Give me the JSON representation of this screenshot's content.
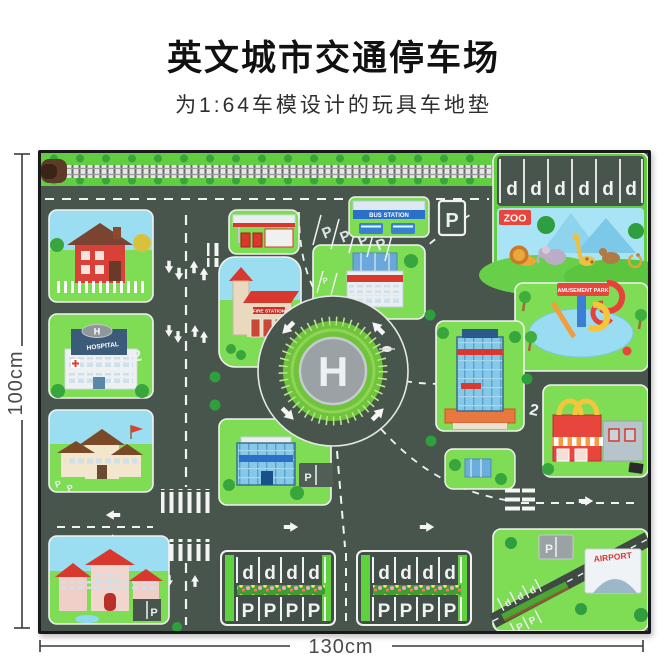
{
  "header": {
    "title": "英文城市交通停车场",
    "subtitle": "为1:64车模设计的玩具车地垫"
  },
  "dimensions": {
    "height": "100cm",
    "width": "130cm"
  },
  "mat": {
    "labels": {
      "p": "P",
      "d": "d",
      "h": "H",
      "lane_2": "2"
    },
    "signs": {
      "zoo": "ZOO",
      "hospital": "HOSPITAL",
      "bus_station": "BUS STATION",
      "fire_station": "FIRE STATION",
      "amusement_park": "AMUSEMENT PARK",
      "airport": "AIRPORT"
    },
    "colors": {
      "road": "#47554c",
      "grass_bright": "#62cd41",
      "block_grass": "#7edd55",
      "sky": "#9bdef2",
      "helipad_gray": "#9aa2a6",
      "accent_red": "#e0412f",
      "accent_blue": "#2a70c8"
    }
  }
}
